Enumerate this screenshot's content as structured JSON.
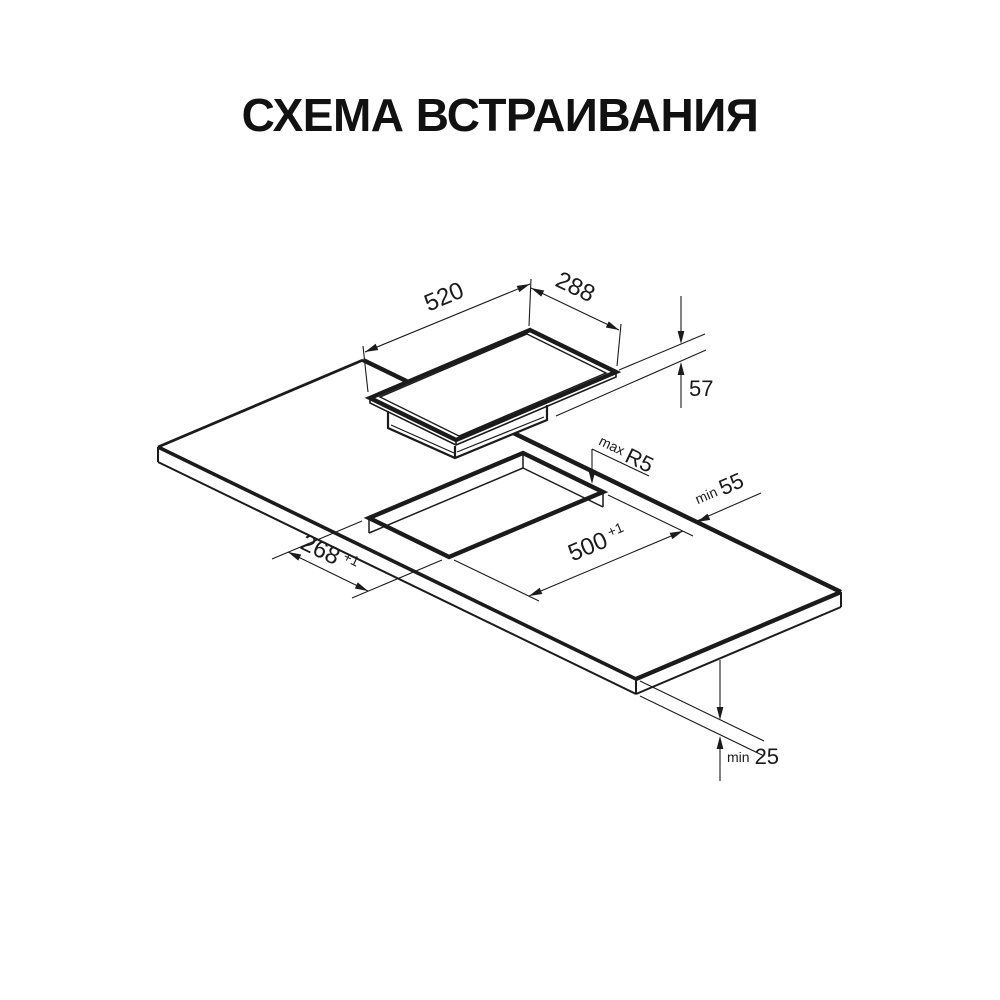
{
  "title": "СХЕМА ВСТРАИВАНИЯ",
  "colors": {
    "ink": "#1b1b1b",
    "background": "#ffffff"
  },
  "dimensions": {
    "hob_length": "520",
    "hob_width": "288",
    "hob_height": "57",
    "cutout_radius_prefix": "max",
    "cutout_radius": "R5",
    "rear_clearance_prefix": "min",
    "rear_clearance": "55",
    "cutout_length": "500",
    "cutout_length_tolerance": "+1",
    "cutout_width": "268",
    "cutout_width_tolerance": "+1",
    "worktop_thickness_prefix": "min",
    "worktop_thickness": "25"
  }
}
